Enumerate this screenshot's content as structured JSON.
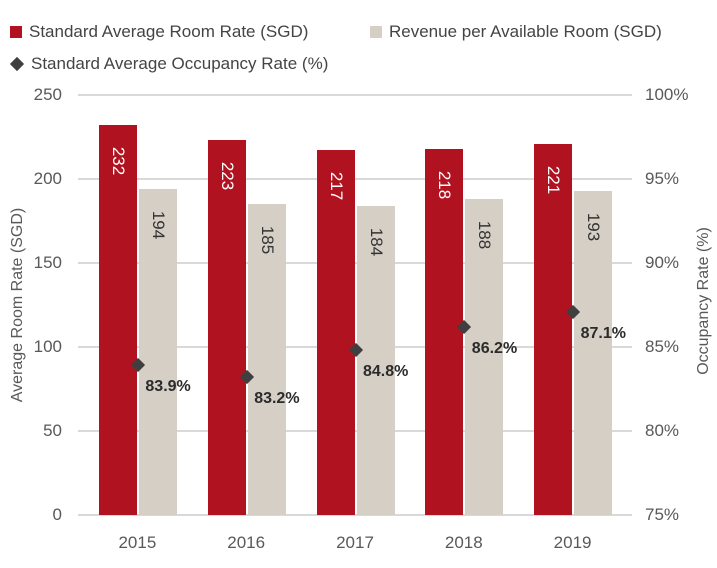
{
  "chart_data": {
    "type": "combo",
    "categories": [
      "2015",
      "2016",
      "2017",
      "2018",
      "2019"
    ],
    "series": [
      {
        "name": "Standard Average Room Rate (SGD)",
        "type": "bar",
        "axis": "left",
        "values": [
          232,
          223,
          217,
          218,
          221
        ],
        "data_labels": [
          "232",
          "223",
          "217",
          "218",
          "221"
        ]
      },
      {
        "name": "Revenue per Available Room (SGD)",
        "type": "bar",
        "axis": "left",
        "values": [
          194,
          185,
          184,
          188,
          193
        ],
        "data_labels": [
          "194",
          "185",
          "184",
          "188",
          "193"
        ]
      },
      {
        "name": "Standard Average Occupancy Rate (%)",
        "type": "scatter",
        "marker": "diamond",
        "axis": "right",
        "values": [
          83.9,
          83.2,
          84.8,
          86.2,
          87.1
        ],
        "data_labels": [
          "83.9%",
          "83.2%",
          "84.8%",
          "86.2%",
          "87.1%"
        ]
      }
    ],
    "left_axis": {
      "title": "Average Room Rate (SGD)",
      "min": 0,
      "max": 250,
      "tick_labels": [
        "0",
        "50",
        "100",
        "150",
        "200",
        "250"
      ]
    },
    "right_axis": {
      "title": "Occupancy Rate (%)",
      "min": 75,
      "max": 100,
      "tick_labels": [
        "75%",
        "80%",
        "85%",
        "90%",
        "95%",
        "100%"
      ]
    },
    "grid": true,
    "legend_position": "top-left"
  },
  "colors": {
    "room_rate_bar": "#B0121F",
    "revpar_bar": "#D6CFC5",
    "occupancy_marker": "#3F3F3F",
    "gridline": "#D9D9D9",
    "axis_text": "#595959",
    "legend_text": "#444444",
    "bar_label_on_red": "#FFFFFF",
    "bar_label_on_beige": "#333333",
    "occupancy_label": "#2B2B2B",
    "background": "#FFFFFF"
  }
}
